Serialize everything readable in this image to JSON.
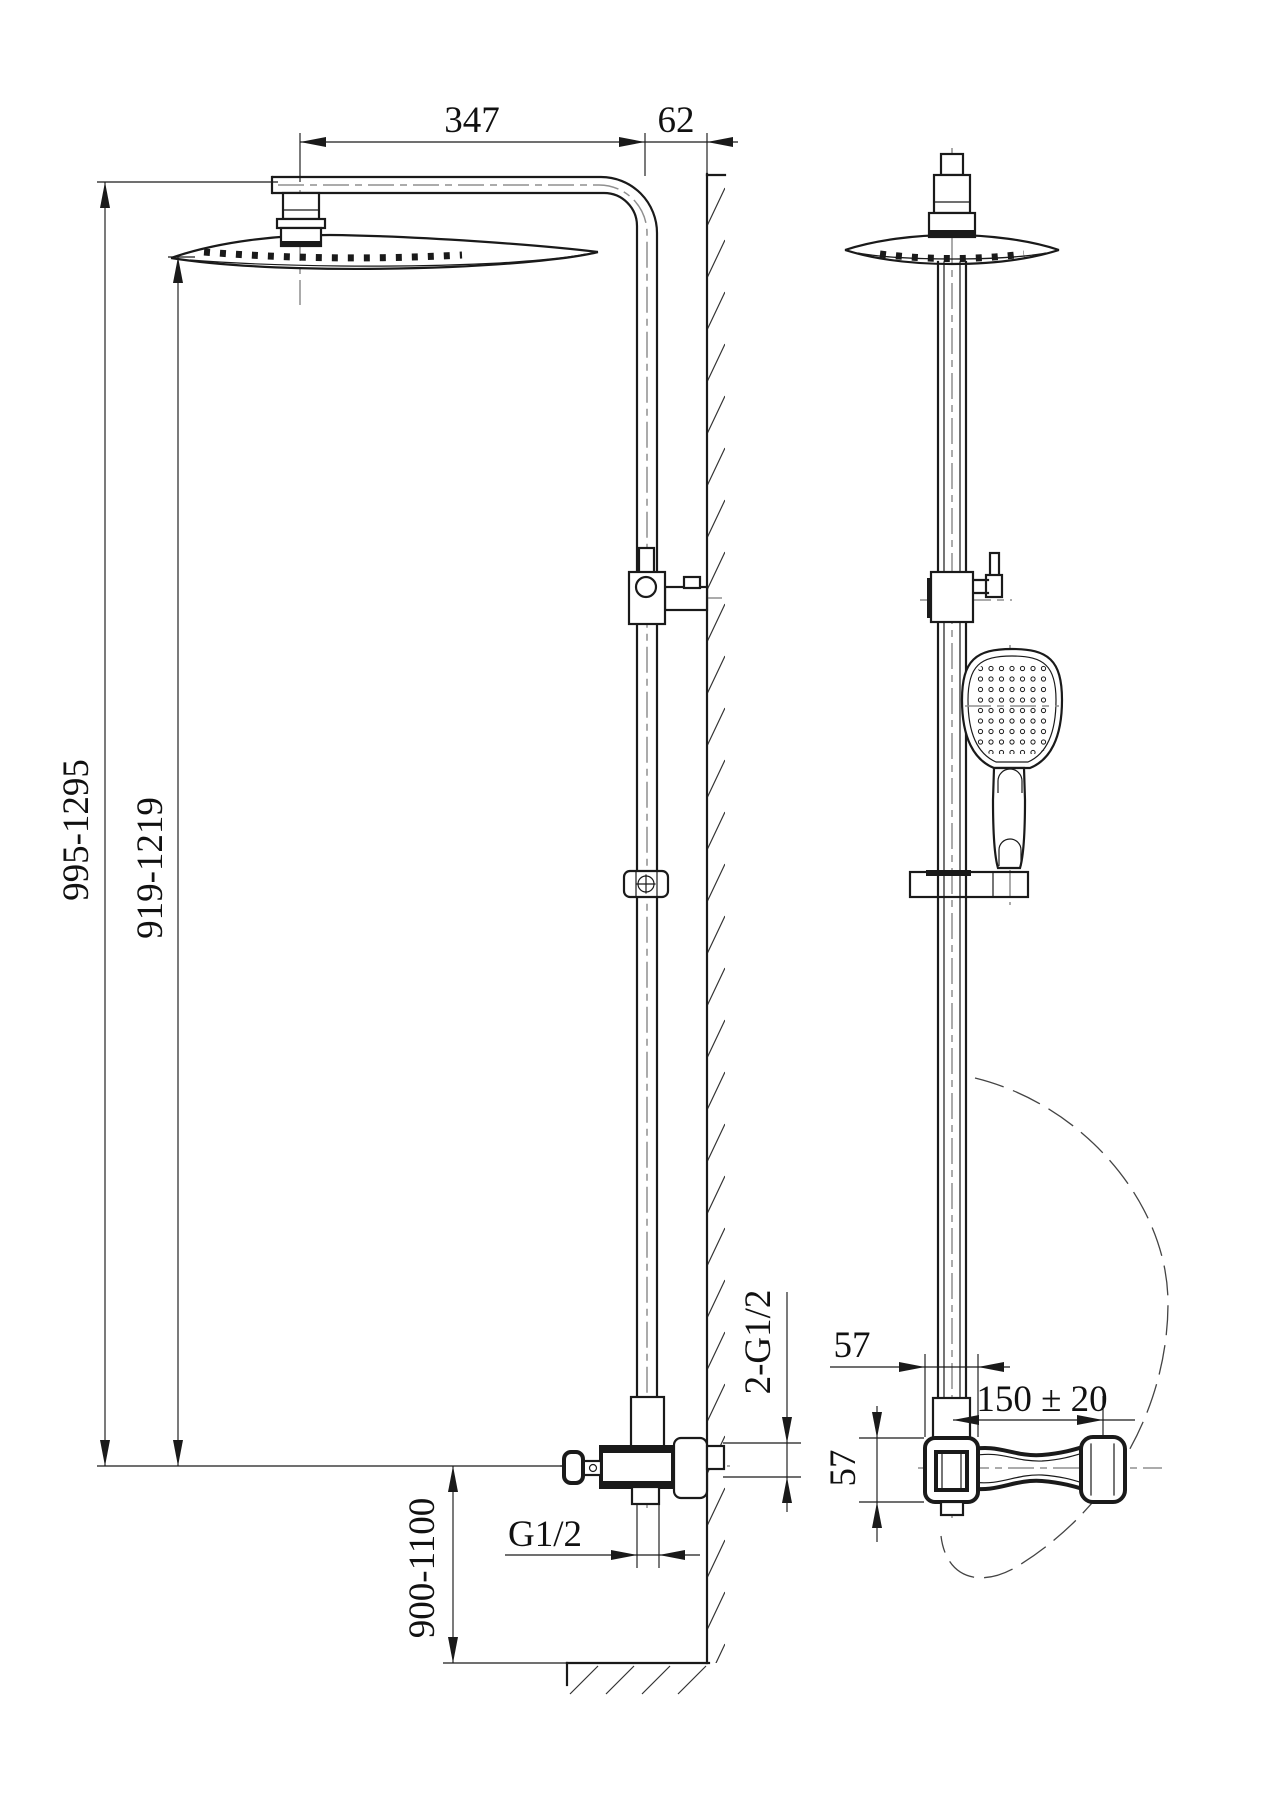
{
  "drawing": {
    "background_color": "#ffffff",
    "line_color": "#1a1a1a",
    "centerline_color": "#8f8f8f",
    "dimensions": {
      "arm_length": "347",
      "wall_offset": "62",
      "overall_height_range": "995-1295",
      "head_height_range": "919-1219",
      "valve_height_range": "900-1100",
      "outlet_thread": "G1/2",
      "wall_inlet_threads": "2-G1/2",
      "valve_body_width": "57",
      "valve_body_height": "57",
      "supply_centre_spacing": "150 ± 20"
    }
  }
}
